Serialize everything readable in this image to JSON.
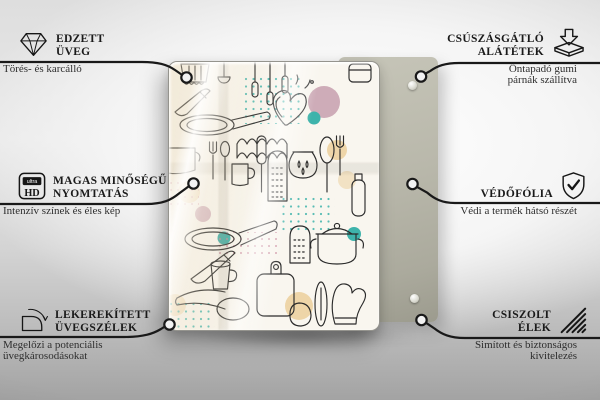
{
  "features": [
    {
      "id": "tempered-glass",
      "icon": "diamond-icon",
      "title_line1": "EDZETT",
      "title_line2": "ÜVEG",
      "desc_line1": "Törés- és karcálló",
      "desc_line2": ""
    },
    {
      "id": "high-quality-print",
      "icon": "ultra-hd-icon",
      "icon_text_top": "ultra",
      "icon_text_bottom": "HD",
      "title_line1": "MAGAS MINŐSÉGŰ",
      "title_line2": "NYOMTATÁS",
      "desc_line1": "Intenzív színek és éles kép",
      "desc_line2": ""
    },
    {
      "id": "rounded-glass-edges",
      "icon": "rounded-corner-icon",
      "title_line1": "LEKEREKÍTETT",
      "title_line2": "ÜVEGSZÉLEK",
      "desc_line1": "Megelőzi a potenciális",
      "desc_line2": "üvegkárosodásokat"
    },
    {
      "id": "anti-slip-pads",
      "icon": "arrow-into-pad-icon",
      "title_line1": "CSÚSZÁSGÁTLÓ",
      "title_line2": "ALÁTÉTEK",
      "desc_line1": "Öntapadó gumi",
      "desc_line2": "párnák szállítva"
    },
    {
      "id": "protective-film",
      "icon": "shield-check-icon",
      "title_line1": "VÉDŐFÓLIA",
      "title_line2": "",
      "desc_line1": "Védi a termék hátsó részét",
      "desc_line2": ""
    },
    {
      "id": "polished-edges",
      "icon": "hatched-edge-icon",
      "title_line1": "CSISZOLT",
      "title_line2": "ÉLEK",
      "desc_line1": "Simított és biztonságos",
      "desc_line2": "kivitelezés"
    }
  ],
  "colors": {
    "doodle_line": "#2b2b2b",
    "connector": "#191919",
    "accent_teal": "#3eb3ab",
    "accent_pink": "#c79fae",
    "accent_pink_dots": "#c9879b",
    "accent_tan": "#ecd2a0",
    "back_panel": "#b9b8ab",
    "glass_bg": "#f9f6ef"
  }
}
